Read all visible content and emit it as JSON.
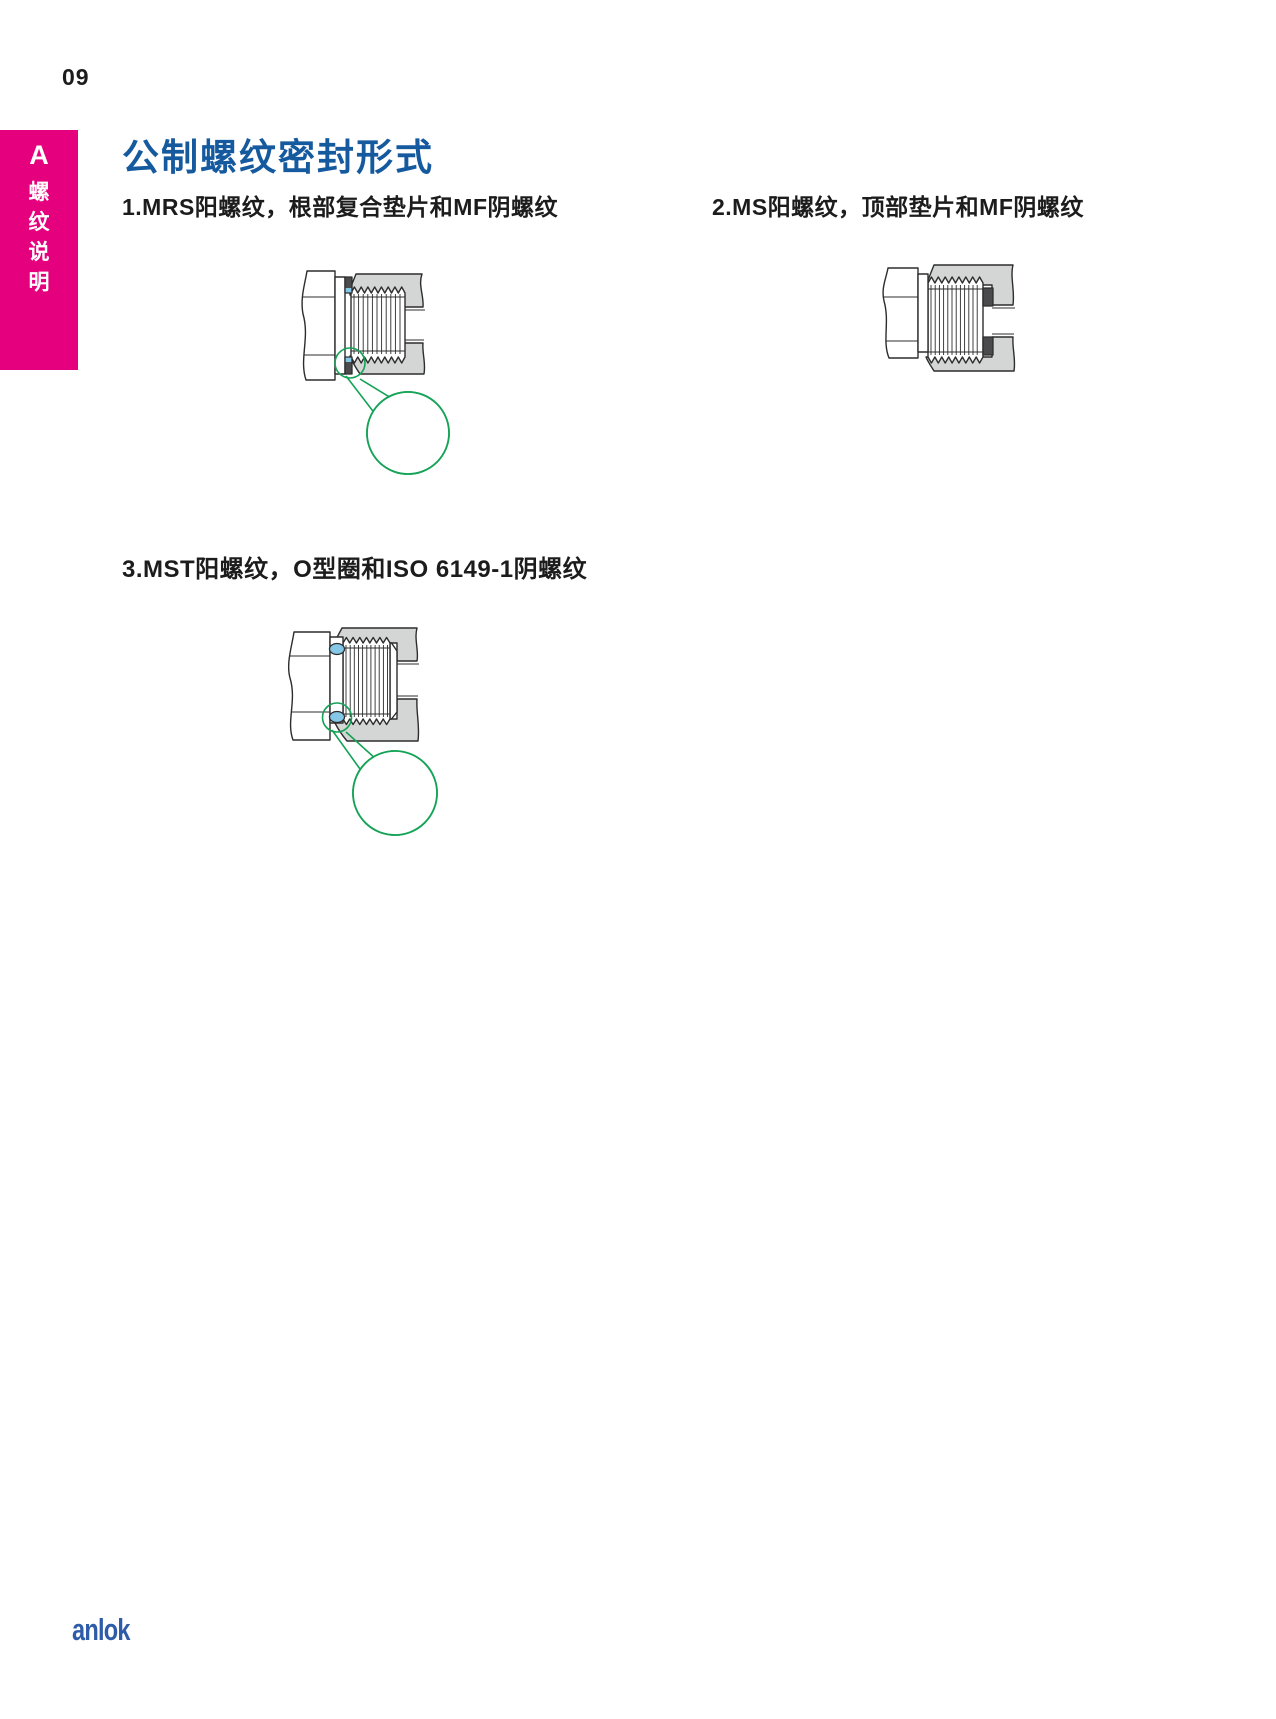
{
  "page": {
    "number": "09"
  },
  "sidebar_tab": {
    "section_letter": "A",
    "label": "螺纹说明",
    "chars": [
      "螺",
      "纹",
      "说",
      "明"
    ]
  },
  "main": {
    "title": "公制螺纹密封形式",
    "items": [
      {
        "label": "1.MRS阳螺纹，根部复合垫片和MF阴螺纹",
        "diagram": "mrs-male-root-composite-gasket-mf-female"
      },
      {
        "label": "2.MS阳螺纹，顶部垫片和MF阴螺纹",
        "diagram": "ms-male-top-gasket-mf-female"
      },
      {
        "label": "3.MST阳螺纹，O型圈和ISO 6149-1阴螺纹",
        "diagram": "mst-male-oring-iso6149-1-female"
      }
    ]
  },
  "footer": {
    "logo": "anlok"
  },
  "colors": {
    "pink": "#E5017E",
    "title_blue": "#15599E",
    "ink": "#1C1C1C",
    "logo_blue": "#2F5CA8",
    "body_gray": "#D4D6D5",
    "outline": "#2D2D2D",
    "gasket_dark": "#4B4B4D",
    "seal_blue": "#84C7E6",
    "green": "#14A356"
  }
}
